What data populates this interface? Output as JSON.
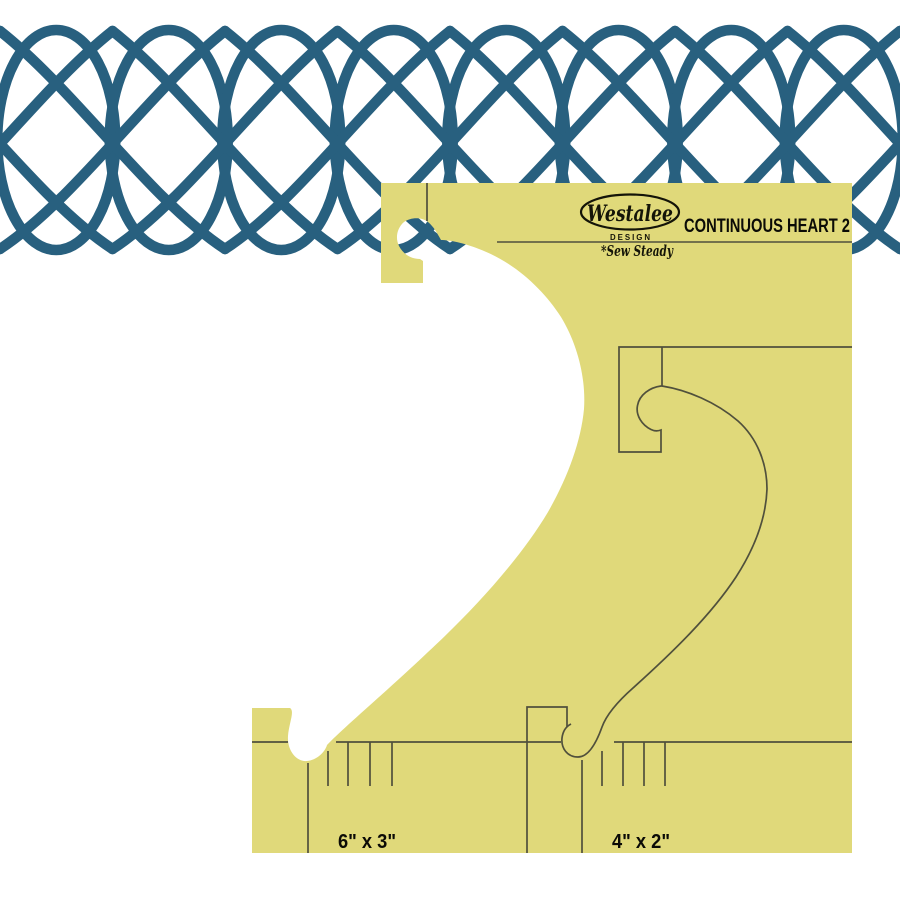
{
  "product": {
    "title": "CONTINUOUS HEART 2",
    "logo": {
      "brand": "Westalee",
      "sub": "DESIGN",
      "tagline": "*Sew Steady"
    },
    "size_labels": {
      "large_heart": "6\" x 3\"",
      "small_heart": "4\" x 2\""
    }
  },
  "colors": {
    "stitch_blue": "#28607f",
    "template_yellow": "#e0d97a",
    "engraving": "#50503c",
    "page_background": "#ffffff"
  },
  "pattern": {
    "type": "interlocking-heart-stitch-border",
    "period_px": 112.5,
    "band_top_px": 26,
    "band_bottom_px": 254,
    "ellipse_count": 8
  }
}
